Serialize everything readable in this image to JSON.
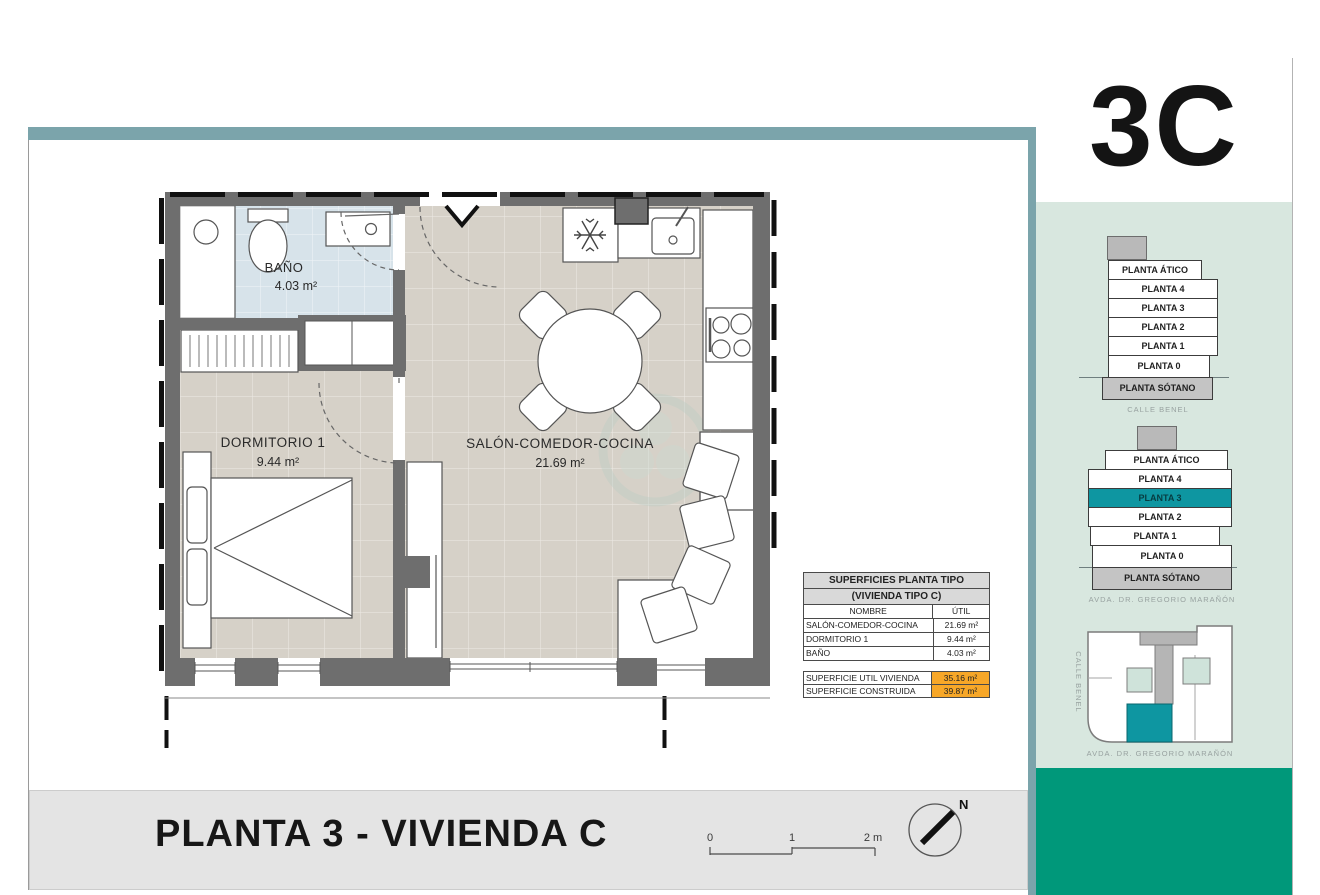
{
  "unit_label": "3C",
  "title_bar": {
    "title": "PLANTA 3 - VIVIENDA C"
  },
  "scale_bar": {
    "tick0": "0",
    "tick1": "1",
    "tick2": "2 m"
  },
  "north_arrow": {
    "label": "N"
  },
  "plan": {
    "rooms": [
      {
        "name": "BAÑO",
        "area": "4.03 m²"
      },
      {
        "name": "DORMITORIO 1",
        "area": "9.44 m²"
      },
      {
        "name": "SALÓN-COMEDOR-COCINA",
        "area": "21.69 m²"
      }
    ]
  },
  "areas_table": {
    "title_line1": "SUPERFICIES PLANTA TIPO",
    "title_line2": "(VIVIENDA TIPO C)",
    "col_name": "NOMBRE",
    "col_util": "ÚTIL",
    "rows": [
      {
        "name": "SALÓN-COMEDOR-COCINA",
        "util": "21.69 m²"
      },
      {
        "name": "DORMITORIO 1",
        "util": "9.44 m²"
      },
      {
        "name": "BAÑO",
        "util": "4.03 m²"
      }
    ],
    "totals": [
      {
        "name": "SUPERFICIE UTIL VIVIENDA",
        "util": "35.16 m²"
      },
      {
        "name": "SUPERFICIE CONSTRUIDA",
        "util": "39.87 m²"
      }
    ]
  },
  "sidebar": {
    "stack1": {
      "floors": [
        "PLANTA ÁTICO",
        "PLANTA 4",
        "PLANTA 3",
        "PLANTA 2",
        "PLANTA 1",
        "PLANTA 0",
        "PLANTA SÓTANO"
      ],
      "street": "CALLE BENEL"
    },
    "stack2": {
      "floors": [
        "PLANTA ÁTICO",
        "PLANTA 4",
        "PLANTA 3",
        "PLANTA 2",
        "PLANTA 1",
        "PLANTA 0",
        "PLANTA SÓTANO"
      ],
      "highlighted_floor": "PLANTA 3",
      "street": "AVDA. DR. GREGORIO MARAÑÓN"
    },
    "siteplan": {
      "street_left": "CALLE BENEL",
      "street_bottom": "AVDA. DR. GREGORIO MARAÑÓN"
    }
  },
  "colors": {
    "band_teal": "#7BA4AB",
    "sidebar_green": "#D8E7DF",
    "highlight_teal": "#0E96A1",
    "brand_green": "#00987A",
    "total_orange": "#F7A728",
    "wall_gray": "#6E6E6E",
    "floor_beige": "#D6D1C8",
    "bath_blue": "#D7E3EA"
  }
}
